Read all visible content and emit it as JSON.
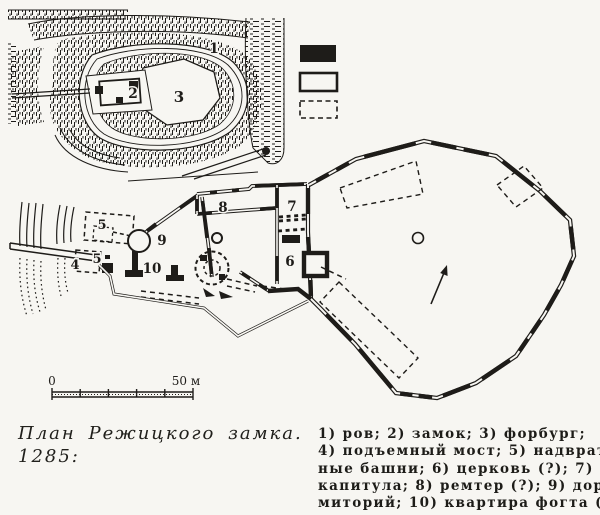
{
  "colors": {
    "ink": "#1e1c19",
    "paper": "#f7f6f2"
  },
  "figure": {
    "inset_labels": {
      "moat": "1",
      "castle": "2",
      "forburg": "3"
    },
    "plan_labels": {
      "drawbridge": "4",
      "gate_tower_upper": "5",
      "gate_tower_lower": "5",
      "church": "6",
      "chapter_hall": "7",
      "remter": "8",
      "dormitory": "9",
      "vogt_quarters": "10"
    },
    "map_key": {
      "items": [
        {
          "name": "filled-wall-swatch",
          "style": "filled"
        },
        {
          "name": "outline-wall-swatch",
          "style": "outline"
        },
        {
          "name": "dashed-foundation-swatch",
          "style": "dashed"
        }
      ]
    },
    "scale": {
      "start": "0",
      "end": "50 м"
    }
  },
  "caption": {
    "line1": "План Режицкого замка.",
    "line2": "1285:"
  },
  "key": {
    "lines": [
      "1) ров; 2) замок; 3) форбург;",
      "4) подъемный мост; 5) надврат-",
      "ные башни; 6) церковь (?); 7) зал",
      "капитула; 8) ремтер (?); 9) дор-",
      "миторий; 10) квартира фогта (?)"
    ]
  }
}
